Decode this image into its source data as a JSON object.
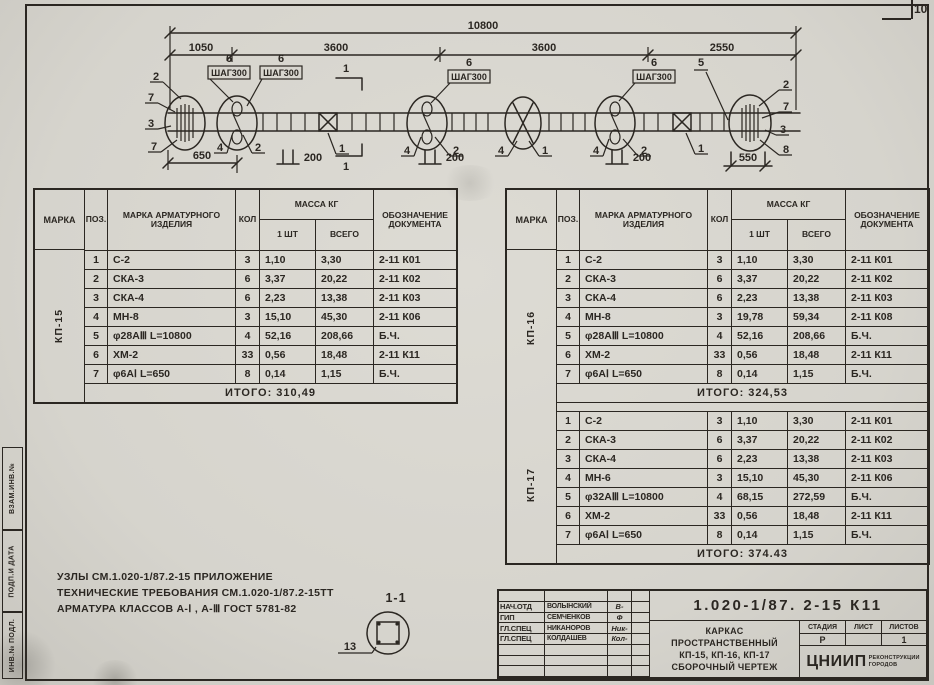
{
  "page": {
    "number": "10"
  },
  "side_stamps": {
    "top": "ВЗАМ.ИНВ.№",
    "middle": "ПОДП.И ДАТА",
    "bottom": "ИНВ.№ ПОДЛ."
  },
  "drawing": {
    "dim_overall": "10800",
    "dim_segments": [
      "1050",
      "3600",
      "3600",
      "2550"
    ],
    "step_label": "ШАГ300",
    "step_qty": "6",
    "pos_bar": "5",
    "dim_left_end": "650",
    "dim_step": "200",
    "dim_right_end": "550",
    "section_mark": "1",
    "left_leaders": [
      "2",
      "7",
      "3",
      "7"
    ],
    "right_leaders": [
      "2",
      "7",
      "3",
      "8"
    ],
    "pos_label_4": "4",
    "pos_label_2": "2",
    "pos_label_1": "1",
    "detail": {
      "title": "1-1",
      "pos": "13"
    }
  },
  "table_header": {
    "marka": "МАРКА",
    "pos": "ПОЗ.",
    "name": "МАРКА АРМАТУРНОГО ИЗДЕЛИЯ",
    "qty": "КОЛ",
    "mass": "МАССА КГ",
    "one": "1 ШТ",
    "total": "ВСЕГО",
    "doc": "ОБОЗНАЧЕНИЕ ДОКУМЕНТА"
  },
  "left_table": {
    "marka": "КП-15",
    "rows": [
      {
        "pos": "1",
        "name": "С-2",
        "qty": "3",
        "one": "1,10",
        "total": "3,30",
        "doc": "2-11 К01"
      },
      {
        "pos": "2",
        "name": "СКА-3",
        "qty": "6",
        "one": "3,37",
        "total": "20,22",
        "doc": "2-11 К02"
      },
      {
        "pos": "3",
        "name": "СКА-4",
        "qty": "6",
        "one": "2,23",
        "total": "13,38",
        "doc": "2-11 К03"
      },
      {
        "pos": "4",
        "name": "МН-8",
        "qty": "3",
        "one": "15,10",
        "total": "45,30",
        "doc": "2-11 К06"
      },
      {
        "pos": "5",
        "name": "φ28АⅢ  L=10800",
        "qty": "4",
        "one": "52,16",
        "total": "208,66",
        "doc": "Б.Ч."
      },
      {
        "pos": "6",
        "name": "ХМ-2",
        "qty": "33",
        "one": "0,56",
        "total": "18,48",
        "doc": "2-11 К11"
      },
      {
        "pos": "7",
        "name": "φ6АⅠ  L=650",
        "qty": "8",
        "one": "0,14",
        "total": "1,15",
        "doc": "Б.Ч."
      }
    ],
    "total": "ИТОГО: 310,49"
  },
  "right_table": {
    "groups": [
      {
        "marka": "КП-16",
        "rows": [
          {
            "pos": "1",
            "name": "С-2",
            "qty": "3",
            "one": "1,10",
            "total": "3,30",
            "doc": "2-11 К01"
          },
          {
            "pos": "2",
            "name": "СКА-3",
            "qty": "6",
            "one": "3,37",
            "total": "20,22",
            "doc": "2-11 К02"
          },
          {
            "pos": "3",
            "name": "СКА-4",
            "qty": "6",
            "one": "2,23",
            "total": "13,38",
            "doc": "2-11 К03"
          },
          {
            "pos": "4",
            "name": "МН-8",
            "qty": "3",
            "one": "19,78",
            "total": "59,34",
            "doc": "2-11 К08"
          },
          {
            "pos": "5",
            "name": "φ28АⅢ  L=10800",
            "qty": "4",
            "one": "52,16",
            "total": "208,66",
            "doc": "Б.Ч."
          },
          {
            "pos": "6",
            "name": "ХМ-2",
            "qty": "33",
            "one": "0,56",
            "total": "18,48",
            "doc": "2-11 К11"
          },
          {
            "pos": "7",
            "name": "φ6АⅠ  L=650",
            "qty": "8",
            "one": "0,14",
            "total": "1,15",
            "doc": "Б.Ч."
          }
        ],
        "total": "ИТОГО: 324,53"
      },
      {
        "marka": "КП-17",
        "rows": [
          {
            "pos": "1",
            "name": "С-2",
            "qty": "3",
            "one": "1,10",
            "total": "3,30",
            "doc": "2-11 К01"
          },
          {
            "pos": "2",
            "name": "СКА-3",
            "qty": "6",
            "one": "3,37",
            "total": "20,22",
            "doc": "2-11 К02"
          },
          {
            "pos": "3",
            "name": "СКА-4",
            "qty": "6",
            "one": "2,23",
            "total": "13,38",
            "doc": "2-11 К03"
          },
          {
            "pos": "4",
            "name": "МН-6",
            "qty": "3",
            "one": "15,10",
            "total": "45,30",
            "doc": "2-11 К06"
          },
          {
            "pos": "5",
            "name": "φ32АⅢ  L=10800",
            "qty": "4",
            "one": "68,15",
            "total": "272,59",
            "doc": "Б.Ч."
          },
          {
            "pos": "6",
            "name": "ХМ-2",
            "qty": "33",
            "one": "0,56",
            "total": "18,48",
            "doc": "2-11 К11"
          },
          {
            "pos": "7",
            "name": "φ6АⅠ  L=650",
            "qty": "8",
            "one": "0,14",
            "total": "1,15",
            "doc": "Б.Ч."
          }
        ],
        "total": "ИТОГО: 374.43"
      }
    ]
  },
  "notes": {
    "line1": "УЗЛЫ СМ.1.020-1/87.2-15 ПРИЛОЖЕНИЕ",
    "line2": "ТЕХНИЧЕСКИЕ ТРЕБОВАНИЯ СМ.1.020-1/87.2-15ТТ",
    "line3": "АРМАТУРА КЛАССОВ А-Ⅰ , А-Ⅲ ГОСТ 5781-82"
  },
  "titleblock": {
    "doc_number": "1.020-1/87. 2-15 К11",
    "title_line1": "КАРКАС",
    "title_line2": "ПРОСТРАНСТВЕННЫЙ",
    "title_line3": "КП-15, КП-16, КП-17",
    "title_line4": "СБОРОЧНЫЙ ЧЕРТЕЖ",
    "stage_label": "СТАДИЯ",
    "sheet_label": "ЛИСТ",
    "sheets_label": "ЛИСТОВ",
    "stage_value": "Р",
    "sheet_value": "",
    "sheets_value": "1",
    "org_name": "ЦНИИП",
    "org_sub1": "РЕКОНСТРУКЦИИ",
    "org_sub2": "ГОРОДОВ",
    "signers": [
      {
        "role": "НАЧ.ОТД",
        "name": "ВОЛЫНСКИЙ",
        "sig": "В-"
      },
      {
        "role": "ГИП",
        "name": "СЕМЧЕНКОВ",
        "sig": "Ф"
      },
      {
        "role": "ГЛ.СПЕЦ",
        "name": "НИКАНОРОВ",
        "sig": "Ник-"
      },
      {
        "role": "ГЛ.СПЕЦ",
        "name": "КОЛДАШЕВ",
        "sig": "Кол-"
      }
    ]
  },
  "colors": {
    "ink": "#2b2722",
    "paper": "#d8d6cf"
  }
}
